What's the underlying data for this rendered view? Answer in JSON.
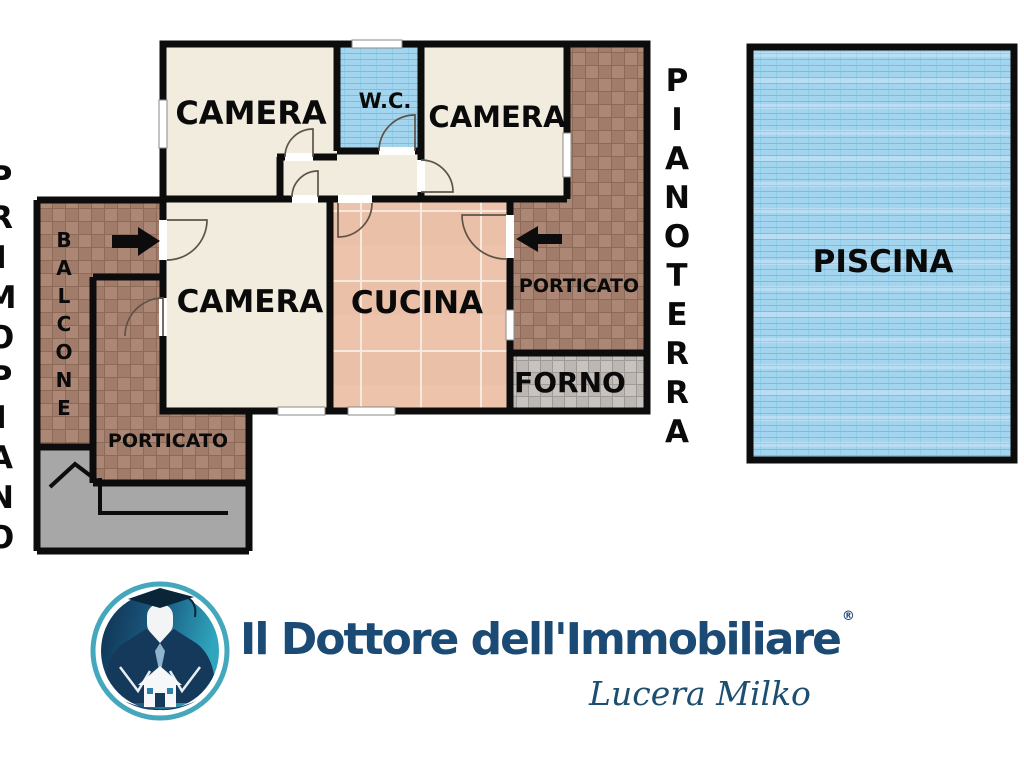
{
  "plan": {
    "rooms": {
      "camera1": "CAMERA",
      "wc": "W.C.",
      "camera2": "CAMERA",
      "camera3": "CAMERA",
      "cucina": "CUCINA",
      "porticato_right": "PORTICATO",
      "forno": "FORNO",
      "balcone": "BALCONE",
      "porticato_left": "PORTICATO",
      "piscina": "PISCINA"
    },
    "floor_labels": {
      "ground": "PIANOTERRA",
      "first": "PRIMOPIANO"
    }
  },
  "branding": {
    "company": "Il Dottore dell'Immobiliare",
    "registered_mark": "®",
    "agent": "Lucera Milko"
  },
  "colors": {
    "wall": "#0c0c0c",
    "floor_cream": "#f2ecdf",
    "tile_pink": "#edc3ac",
    "tile_blue": "#a3d5ee",
    "tile_brown": "#a98473",
    "tile_gray": "#c7c3bf",
    "stairs_gray": "#a7a7a7",
    "brand_navy": "#1b4a75",
    "logo_teal": "#2fa6bd"
  }
}
